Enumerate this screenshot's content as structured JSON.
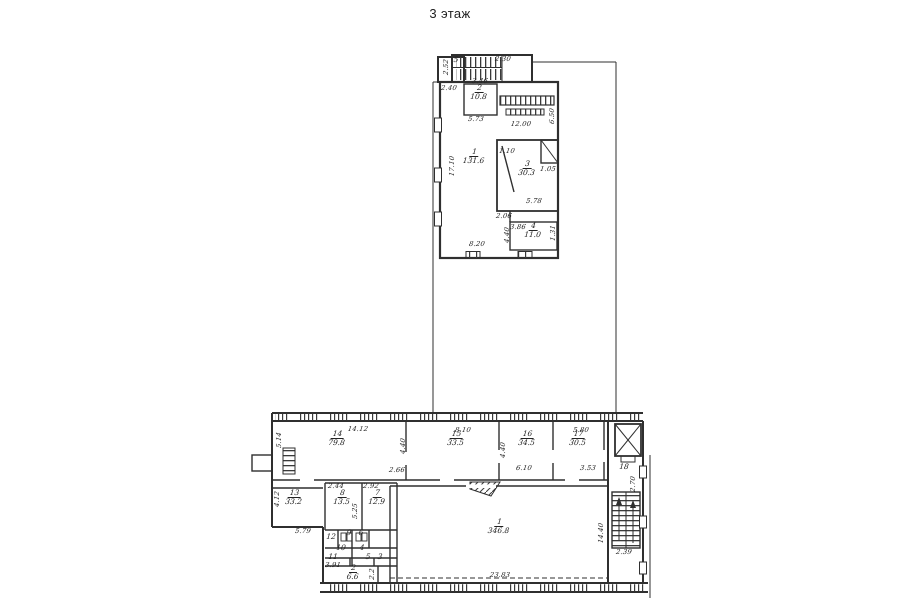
{
  "title": "3 этаж",
  "colors": {
    "ink": "#2f2f2f",
    "paper": "#ffffff"
  },
  "floor_plan": {
    "rooms": [
      {
        "num": "1",
        "area": "131.6",
        "x": 474,
        "y": 152
      },
      {
        "num": "2",
        "area": "10.8",
        "x": 479,
        "y": 88
      },
      {
        "num": "3",
        "area": "30.3",
        "x": 527,
        "y": 164
      },
      {
        "num": "4",
        "area": "11.0",
        "x": 533,
        "y": 226
      },
      {
        "num": "5",
        "area": "",
        "x": 456,
        "y": 60
      },
      {
        "num": "14",
        "area": "79.8",
        "x": 337,
        "y": 434
      },
      {
        "num": "15",
        "area": "33.5",
        "x": 456,
        "y": 434
      },
      {
        "num": "16",
        "area": "34.5",
        "x": 527,
        "y": 434
      },
      {
        "num": "17",
        "area": "30.5",
        "x": 578,
        "y": 434
      },
      {
        "num": "18",
        "area": "",
        "x": 624,
        "y": 467
      },
      {
        "num": "13",
        "area": "33.2",
        "x": 294,
        "y": 493
      },
      {
        "num": "8",
        "area": "13.5",
        "x": 342,
        "y": 493
      },
      {
        "num": "7",
        "area": "12.9",
        "x": 377,
        "y": 493
      },
      {
        "num": "12",
        "area": "",
        "x": 331,
        "y": 537
      },
      {
        "num": "9",
        "area": "",
        "x": 349,
        "y": 533
      },
      {
        "num": "6",
        "area": "",
        "x": 361,
        "y": 533
      },
      {
        "num": "10",
        "area": "",
        "x": 341,
        "y": 548
      },
      {
        "num": "4",
        "area": "",
        "x": 362,
        "y": 548
      },
      {
        "num": "11",
        "area": "",
        "x": 333,
        "y": 557
      },
      {
        "num": "5",
        "area": "",
        "x": 368,
        "y": 557
      },
      {
        "num": "3",
        "area": "",
        "x": 380,
        "y": 557
      },
      {
        "num": "2",
        "area": "6.6",
        "x": 353,
        "y": 568
      },
      {
        "num": "1",
        "area": "346.8",
        "x": 499,
        "y": 522
      }
    ],
    "dims": [
      {
        "text": "2.30",
        "x": 503,
        "y": 59,
        "rot": 0
      },
      {
        "text": "2.52",
        "x": 446,
        "y": 67,
        "rot": 90
      },
      {
        "text": "2.40",
        "x": 449,
        "y": 88,
        "rot": 0
      },
      {
        "text": "3.46",
        "x": 480,
        "y": 81,
        "rot": 0
      },
      {
        "text": "5.73",
        "x": 476,
        "y": 119,
        "rot": 0
      },
      {
        "text": "12.00",
        "x": 521,
        "y": 124,
        "rot": 0
      },
      {
        "text": "17.10",
        "x": 452,
        "y": 166,
        "rot": 90
      },
      {
        "text": "6.50",
        "x": 552,
        "y": 116,
        "rot": 90
      },
      {
        "text": "1.10",
        "x": 507,
        "y": 151,
        "rot": 0
      },
      {
        "text": "1.05",
        "x": 548,
        "y": 169,
        "rot": 0
      },
      {
        "text": "5.78",
        "x": 534,
        "y": 201,
        "rot": 0
      },
      {
        "text": "2.06",
        "x": 504,
        "y": 216,
        "rot": 0
      },
      {
        "text": "3.86",
        "x": 518,
        "y": 227,
        "rot": 0
      },
      {
        "text": "4.40",
        "x": 507,
        "y": 235,
        "rot": 90
      },
      {
        "text": "1.31",
        "x": 553,
        "y": 233,
        "rot": 90
      },
      {
        "text": "8.20",
        "x": 477,
        "y": 244,
        "rot": 0
      },
      {
        "text": "14.12",
        "x": 358,
        "y": 429,
        "rot": 0
      },
      {
        "text": "5.14",
        "x": 279,
        "y": 440,
        "rot": 90
      },
      {
        "text": "8.10",
        "x": 463,
        "y": 430,
        "rot": 0
      },
      {
        "text": "4.40",
        "x": 403,
        "y": 446,
        "rot": 90
      },
      {
        "text": "4.40",
        "x": 503,
        "y": 450,
        "rot": 90
      },
      {
        "text": "2.66",
        "x": 397,
        "y": 470,
        "rot": 0
      },
      {
        "text": "6.10",
        "x": 524,
        "y": 468,
        "rot": 0
      },
      {
        "text": "5.80",
        "x": 581,
        "y": 430,
        "rot": 0
      },
      {
        "text": "3.53",
        "x": 588,
        "y": 468,
        "rot": 0
      },
      {
        "text": "2.70",
        "x": 633,
        "y": 484,
        "rot": 90
      },
      {
        "text": "2.39",
        "x": 624,
        "y": 552,
        "rot": 0
      },
      {
        "text": "14.40",
        "x": 601,
        "y": 533,
        "rot": 90
      },
      {
        "text": "23.83",
        "x": 500,
        "y": 575,
        "rot": 0
      },
      {
        "text": "4.12",
        "x": 277,
        "y": 499,
        "rot": 90
      },
      {
        "text": "5.79",
        "x": 303,
        "y": 531,
        "rot": 0
      },
      {
        "text": "2.44",
        "x": 336,
        "y": 486,
        "rot": 0
      },
      {
        "text": "2.92",
        "x": 371,
        "y": 486,
        "rot": 0
      },
      {
        "text": "5.25",
        "x": 355,
        "y": 511,
        "rot": 90
      },
      {
        "text": "3.91",
        "x": 333,
        "y": 565,
        "rot": 0
      },
      {
        "text": "2.2",
        "x": 372,
        "y": 574,
        "rot": 90
      }
    ]
  }
}
